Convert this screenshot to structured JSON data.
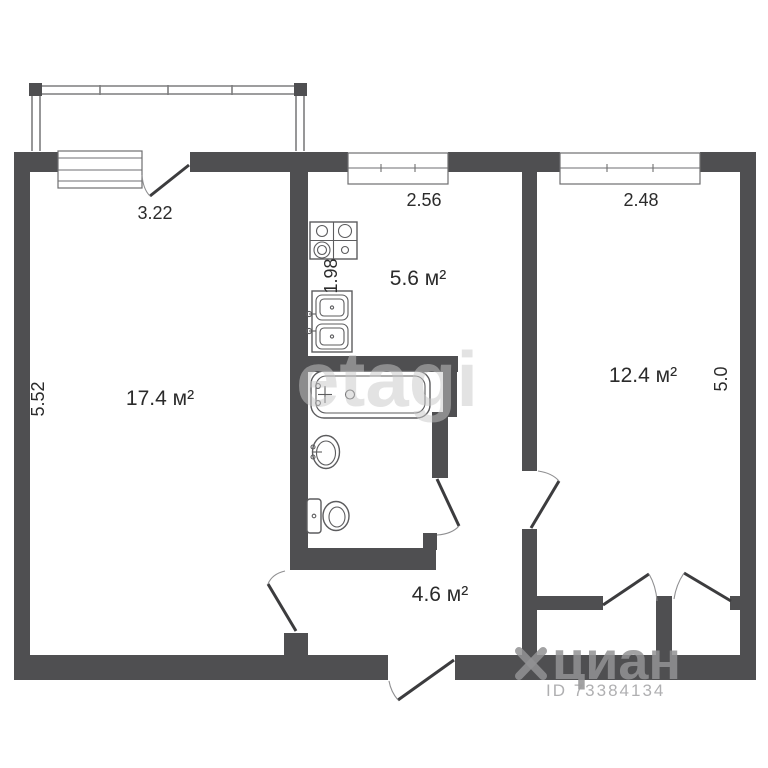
{
  "labels": {
    "living_area": "17.4 м²",
    "kitchen_area": "5.6 м²",
    "bedroom_area": "12.4 м²",
    "hall_area": "4.6 м²",
    "dim_balcony_door": "3.22",
    "dim_living_height": "5.52",
    "dim_kitchen_width": "2.56",
    "dim_kitchen_height": "1.98",
    "dim_bedroom_width": "2.48",
    "dim_bedroom_height": "5.0"
  },
  "watermarks": {
    "center": "etagi",
    "brand": "циан",
    "brand_id": "ID 73384134"
  },
  "colors": {
    "wall": "#4f4f51",
    "text": "#2b2b2b",
    "watermark": "#929294"
  }
}
